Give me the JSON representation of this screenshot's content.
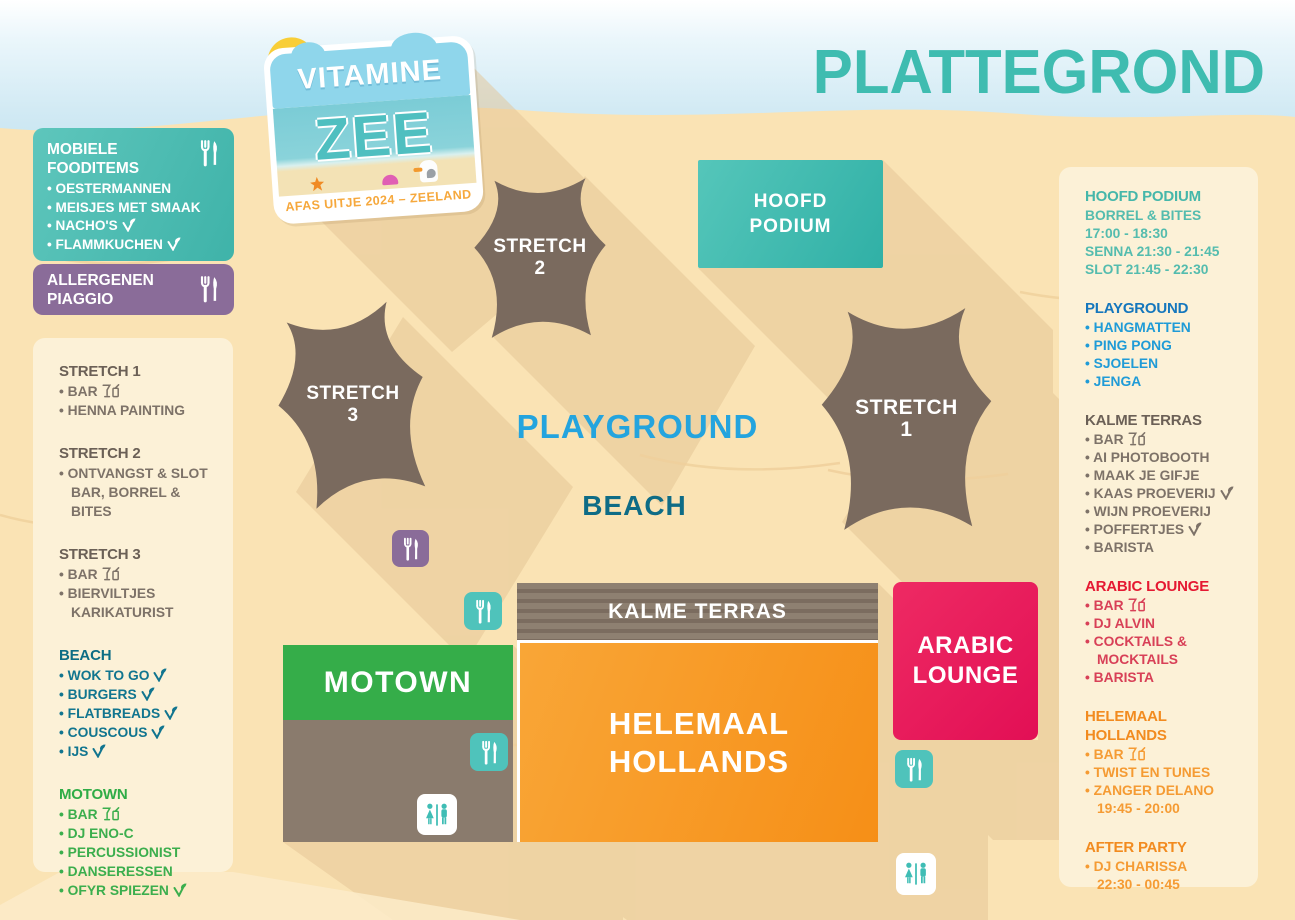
{
  "title": "PLATTEGROND",
  "logo": {
    "title_top": "VITAMINE",
    "title_main": "ZEE",
    "subtitle": "AFAS UITJE 2024 – ZEELAND"
  },
  "food_box": {
    "title": "MOBIELE FOODITEMS",
    "items": [
      {
        "text": "OESTERMANNEN"
      },
      {
        "text": "MEISJES MET SMAAK"
      },
      {
        "text": "NACHO'S",
        "leaf": true
      },
      {
        "text": "FLAMMKUCHEN",
        "leaf": true
      }
    ]
  },
  "allergen_box": {
    "title": "ALLERGENEN PIAGGIO"
  },
  "left_panel": {
    "sections": [
      {
        "title": "STRETCH 1",
        "theme": "gray",
        "items": [
          {
            "text": "BAR",
            "bar": true
          },
          {
            "text": "HENNA PAINTING"
          }
        ]
      },
      {
        "title": "STRETCH 2",
        "theme": "gray",
        "items": [
          {
            "text": "ONTVANGST & SLOT",
            "text2": "BAR, BORREL & BITES"
          }
        ]
      },
      {
        "title": "STRETCH 3",
        "theme": "gray",
        "items": [
          {
            "text": "BAR",
            "bar": true
          },
          {
            "text": "BIERVILTJES",
            "text2": "KARIKATURIST"
          }
        ]
      },
      {
        "title": "BEACH",
        "theme": "teal-dark",
        "items": [
          {
            "text": "WOK TO GO",
            "leaf": true
          },
          {
            "text": "BURGERS",
            "leaf": true
          },
          {
            "text": "FLATBREADS",
            "leaf": true
          },
          {
            "text": "COUSCOUS",
            "leaf": true
          },
          {
            "text": "IJS",
            "leaf": true
          }
        ]
      },
      {
        "title": "MOTOWN",
        "theme": "green",
        "items": [
          {
            "text": "BAR",
            "bar": true
          },
          {
            "text": "DJ ENO-C"
          },
          {
            "text": "PERCUSSIONIST"
          },
          {
            "text": "DANSERESSEN"
          },
          {
            "text": "OFYR SPIEZEN",
            "leaf": true
          }
        ]
      }
    ]
  },
  "right_panel": {
    "sections": [
      {
        "title": "HOOFD PODIUM",
        "theme": "teal",
        "lines": [
          "BORREL & BITES",
          "17:00 - 18:30",
          "SENNA 21:30 - 21:45",
          "SLOT 21:45 - 22:30"
        ]
      },
      {
        "title": "PLAYGROUND",
        "theme": "blue",
        "items": [
          {
            "text": "HANGMATTEN"
          },
          {
            "text": "PING PONG"
          },
          {
            "text": "SJOELEN"
          },
          {
            "text": "JENGA"
          }
        ]
      },
      {
        "title": "KALME TERRAS",
        "theme": "gray",
        "items": [
          {
            "text": "BAR",
            "bar": true
          },
          {
            "text": "AI PHOTOBOOTH"
          },
          {
            "text": "MAAK JE GIFJE"
          },
          {
            "text": "KAAS PROEVERIJ",
            "leaf": true
          },
          {
            "text": "WIJN PROEVERIJ"
          },
          {
            "text": "POFFERTJES",
            "leaf": true
          },
          {
            "text": "BARISTA"
          }
        ]
      },
      {
        "title": "ARABIC LOUNGE",
        "theme": "red",
        "items": [
          {
            "text": "BAR",
            "bar": true
          },
          {
            "text": "DJ ALVIN"
          },
          {
            "text": "COCKTAILS &",
            "text2": "MOCKTAILS"
          },
          {
            "text": "BARISTA"
          }
        ]
      },
      {
        "title": "HELEMAAL HOLLANDS",
        "theme": "orange",
        "items": [
          {
            "text": "BAR",
            "bar": true
          },
          {
            "text": "TWIST EN TUNES"
          },
          {
            "text": "ZANGER DELANO",
            "text2": "19:45 - 20:00"
          }
        ]
      },
      {
        "title": "AFTER PARTY",
        "theme": "orange",
        "items": [
          {
            "text": "DJ CHARISSA",
            "text2": "22:30 - 00:45"
          }
        ]
      }
    ]
  },
  "map": {
    "hoofd_podium": {
      "line1": "HOOFD",
      "line2": "PODIUM"
    },
    "stretch_2": {
      "line1": "STRETCH",
      "line2": "2"
    },
    "stretch_3": {
      "line1": "STRETCH",
      "line2": "3"
    },
    "stretch_1": {
      "line1": "STRETCH",
      "line2": "1"
    },
    "playground_label": "PLAYGROUND",
    "beach_label": "BEACH",
    "kalme_terras_label": "KALME TERRAS",
    "motown_label": "MOTOWN",
    "helemaal_hollands": {
      "line1": "HELEMAAL",
      "line2": "HOLLANDS"
    },
    "arabic_lounge": {
      "line1": "ARABIC",
      "line2": "LOUNGE"
    }
  },
  "icons": {
    "food": "fork-knife-icon",
    "restroom": "man-woman-restroom-icon",
    "bar": "drinks-icon",
    "leaf": "vegetarian-leaf-icon"
  },
  "colors": {
    "sand": "#fae3b4",
    "sky": "#c7e5f1",
    "title_teal": "#3fbcb0",
    "teal_box": "#4fc0b5",
    "purple_box": "#8a6c99",
    "cream_panel": "#fcf1d7",
    "tent": "#7a6a5e",
    "green": "#35ad49",
    "orange": "#f7941e",
    "pink": "#e8175b",
    "blue": "#1f9bd7",
    "dark_teal": "#0e6d84",
    "red": "#e51932",
    "banner_brown": "#857768",
    "shadow": "#e3c493"
  }
}
